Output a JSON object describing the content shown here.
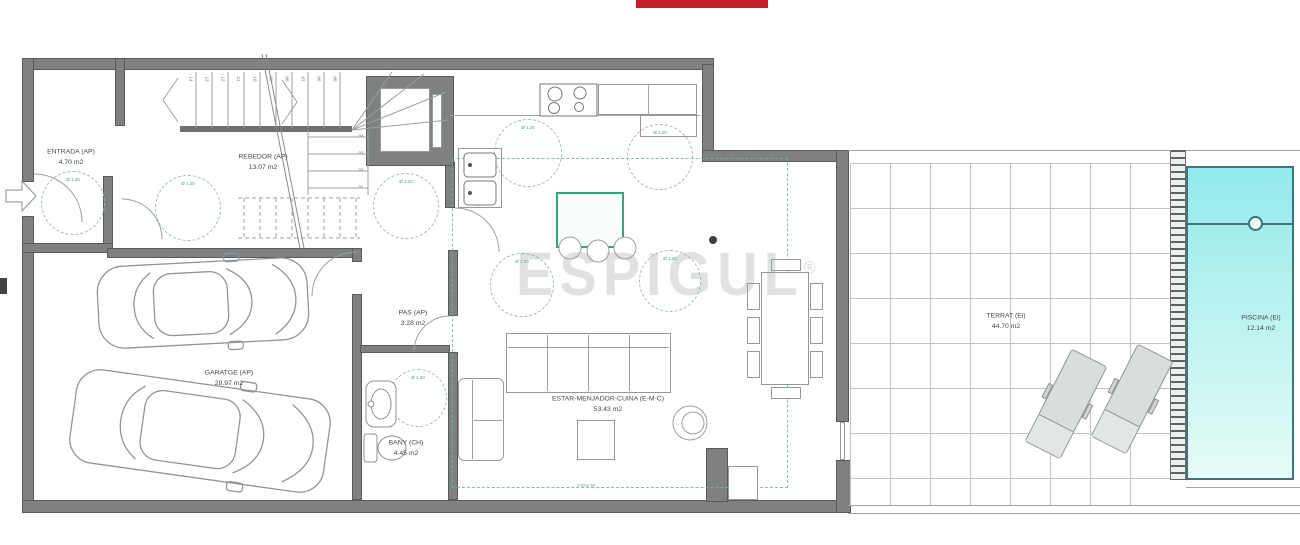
{
  "banner": {
    "color": "#c2202a"
  },
  "watermark": {
    "text": "ESPIGUL",
    "reg": "®"
  },
  "rooms": {
    "entrada": {
      "name": "ENTRADA (AP)",
      "area": "4.70 m2"
    },
    "rebedor": {
      "name": "REBEDOR (AP)",
      "area": "13.07 m2"
    },
    "pas": {
      "name": "PAS (AP)",
      "area": "3.28 m2"
    },
    "garatge": {
      "name": "GARATGE (AP)",
      "area": "28.97 m2"
    },
    "bany": {
      "name": "BANY (CH)",
      "area": "4.45 m2"
    },
    "estar": {
      "name": "ESTAR-MENJADOR-CUINA (E-M-C)",
      "area": "53.43 m2"
    },
    "terrat": {
      "name": "TERRAT (Ei)",
      "area": "44.70 m2"
    },
    "piscina": {
      "name": "PISCINA (Ei)",
      "area": "12.14 m2"
    }
  },
  "labels": {
    "diameter": "Ø 1.20",
    "sink_note": "rentaplats",
    "living_note": "2.60x2.60"
  },
  "stairs": {
    "top_steps": [
      "14",
      "13",
      "12",
      "11",
      "10",
      "09",
      "08",
      "07",
      "06",
      "05"
    ],
    "lower_steps": [
      "04",
      "03",
      "02",
      "01"
    ]
  },
  "colors": {
    "wall": "#7e8081",
    "accent_green": "#3aa379",
    "pool_water": "#93e9ec",
    "pool_border": "#3c7478",
    "banner_red": "#c2202a",
    "watermark_gray": "#9aa0a0"
  }
}
